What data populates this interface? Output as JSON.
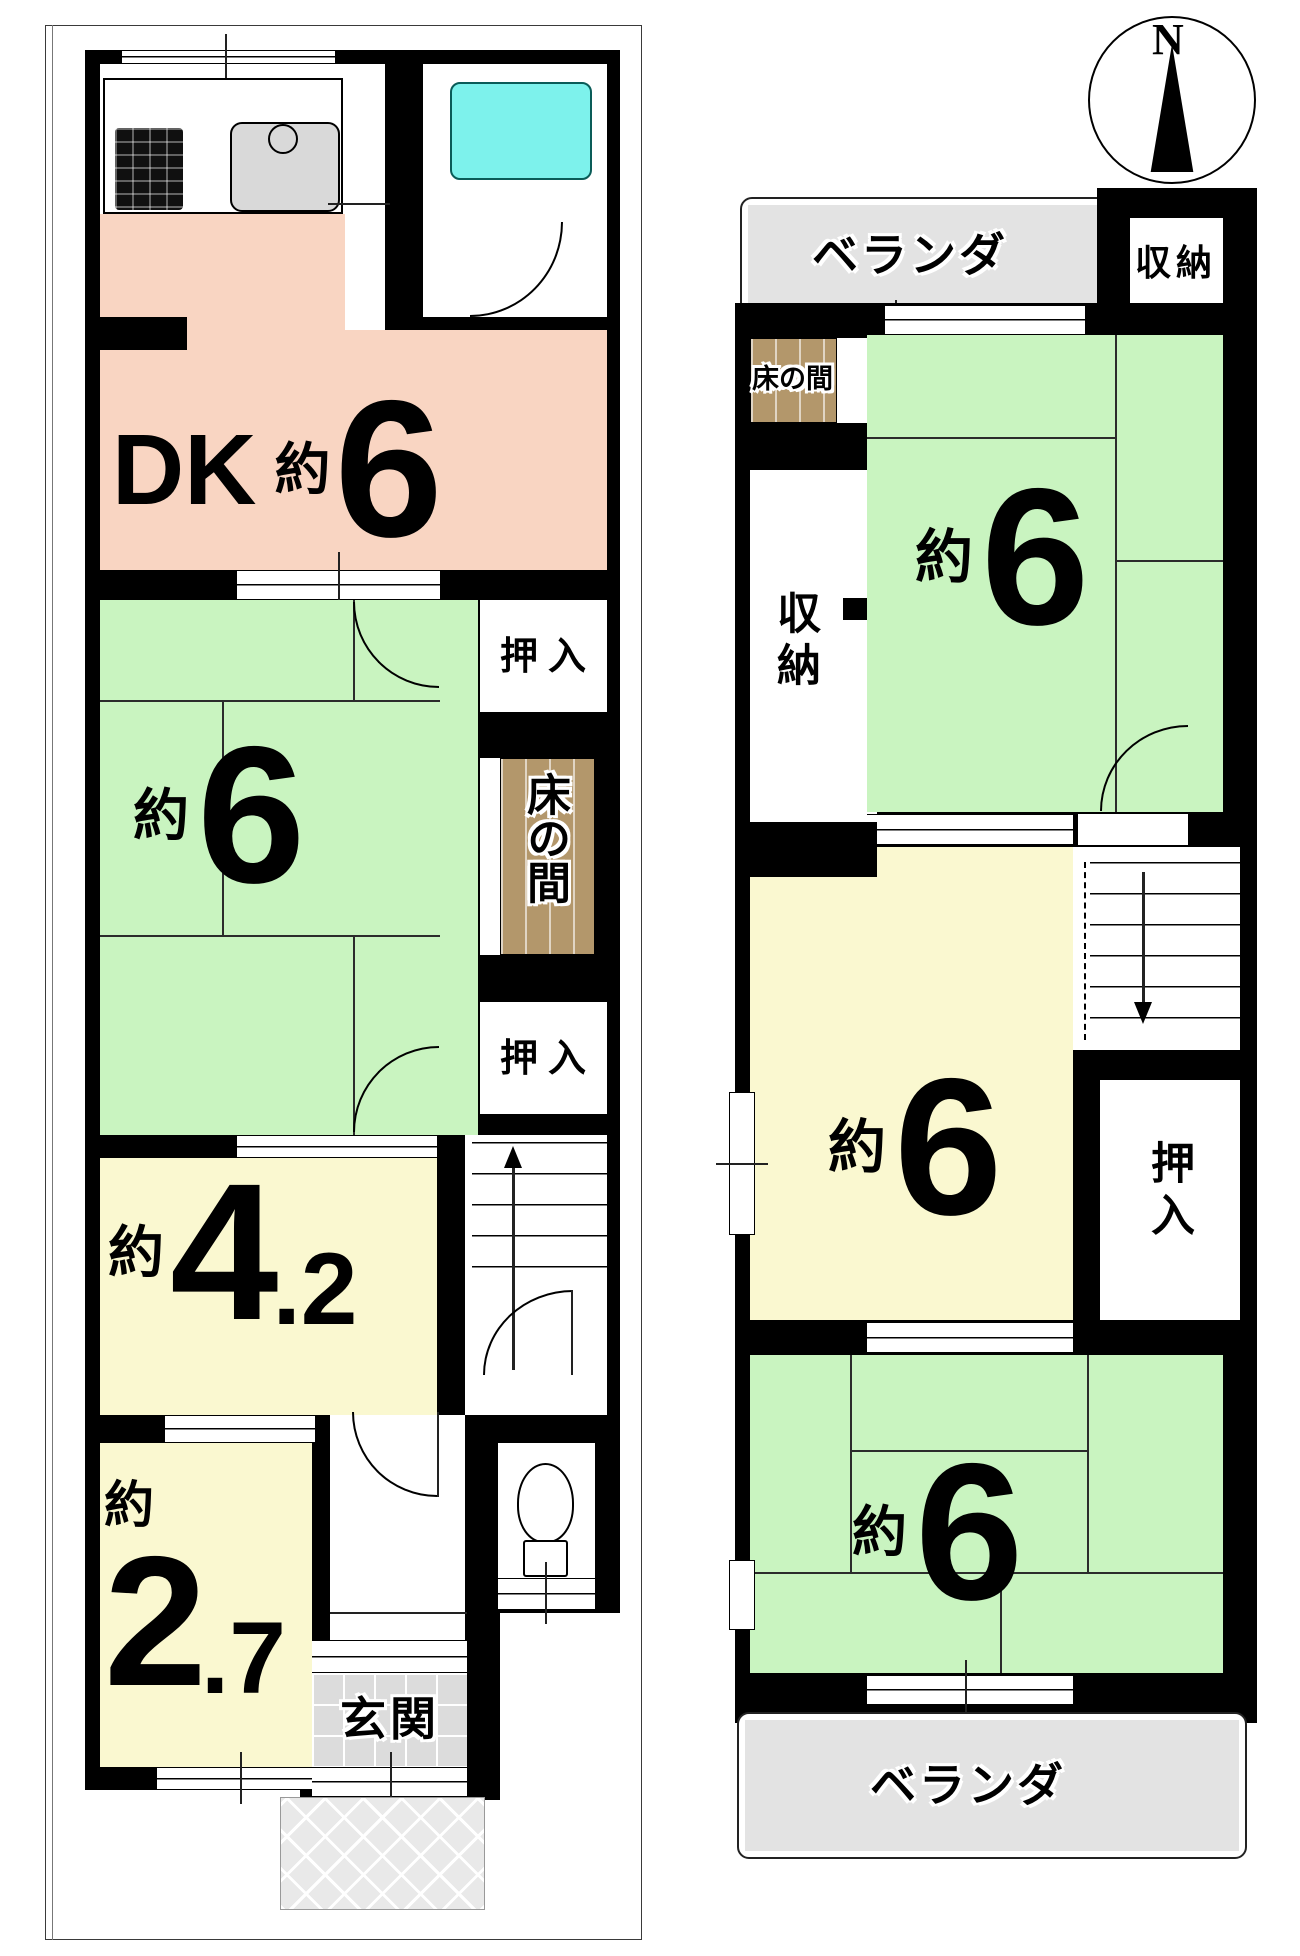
{
  "compass": {
    "north_label": "N"
  },
  "floor1": {
    "dk": {
      "name": "DK",
      "approx": "約",
      "size": "6"
    },
    "tatami6": {
      "approx": "約",
      "size": "6"
    },
    "room4_2": {
      "approx": "約",
      "size_int": "4",
      "size_dec": ".2"
    },
    "room2_7": {
      "approx": "約",
      "size_int": "2",
      "size_dec": ".7"
    },
    "oshiire_upper": "押入",
    "oshiire_lower": "押入",
    "tokonoma": "床の間",
    "genkan": "玄関"
  },
  "floor2": {
    "veranda_north": "ベランダ",
    "veranda_south": "ベランダ",
    "shunou_corner": "収納",
    "shunou_west": "収納",
    "tokonoma": "床の間",
    "tatami6_north": {
      "approx": "約",
      "size": "6"
    },
    "tatami6_middle": {
      "approx": "約",
      "size": "6"
    },
    "tatami6_south": {
      "approx": "約",
      "size": "6"
    },
    "oshiire": "押入"
  },
  "colors": {
    "dk_pink": "#f9d5c2",
    "tatami_green": "#c9f4c0",
    "room_yellow": "#faf8d0",
    "bath_cyan": "#7df2ec",
    "tokonoma_brown": "#b3976b",
    "veranda_gray": "#e3e3e3",
    "wall_black": "#000000"
  }
}
